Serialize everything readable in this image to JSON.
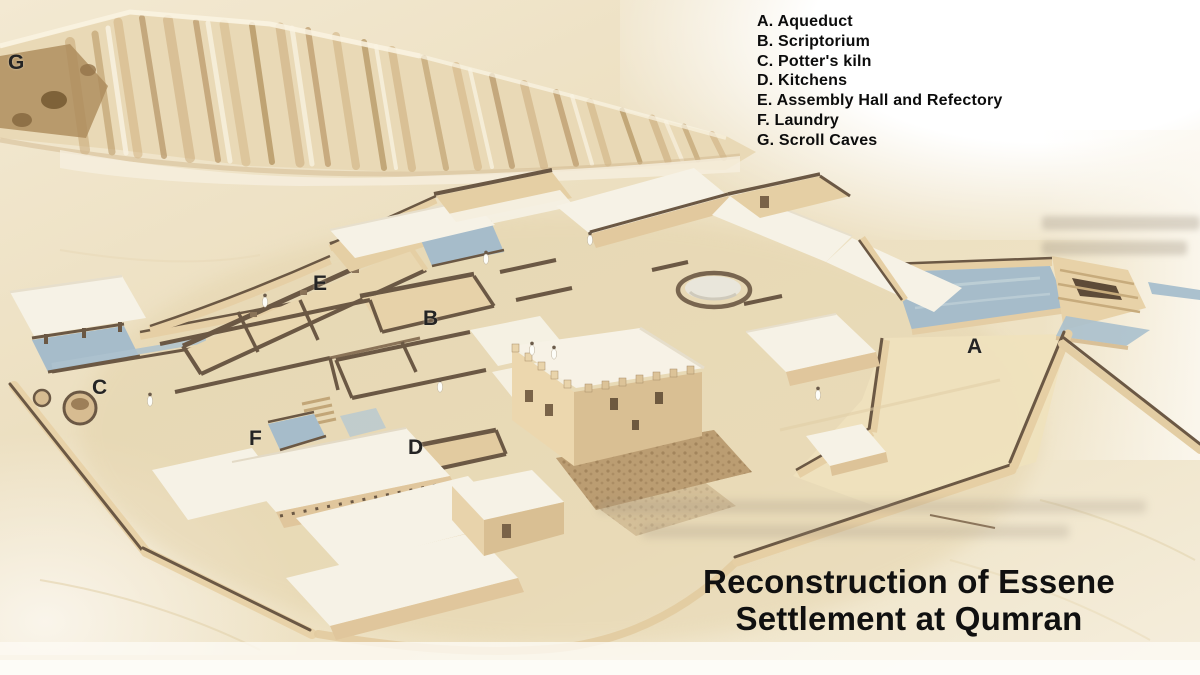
{
  "legend": {
    "items": [
      {
        "letter": "A",
        "label": "Aqueduct"
      },
      {
        "letter": "B",
        "label": "Scriptorium"
      },
      {
        "letter": "C",
        "label": "Potter's kiln"
      },
      {
        "letter": "D",
        "label": "Kitchens"
      },
      {
        "letter": "E",
        "label": "Assembly Hall and Refectory"
      },
      {
        "letter": "F",
        "label": "Laundry"
      },
      {
        "letter": "G",
        "label": "Scroll Caves"
      }
    ]
  },
  "title": {
    "line1": "Reconstruction of Essene",
    "line2": "Settlement at Qumran"
  },
  "illustration": {
    "markers": [
      {
        "letter": "A",
        "x": 967,
        "y": 336
      },
      {
        "letter": "B",
        "x": 423,
        "y": 308
      },
      {
        "letter": "C",
        "x": 92,
        "y": 377
      },
      {
        "letter": "D",
        "x": 408,
        "y": 437
      },
      {
        "letter": "E",
        "x": 313,
        "y": 273
      },
      {
        "letter": "F",
        "x": 249,
        "y": 428
      },
      {
        "letter": "G",
        "x": 8,
        "y": 52
      }
    ],
    "palette": {
      "sand": "#ecdfc0",
      "cliff": "#c4a26e",
      "wall": "#e5cfa4",
      "wall_top": "#6b5844",
      "roof": "#f6f2e6",
      "water": "#a6bcca",
      "stone": "#bb9d72",
      "label_text": "#111111"
    }
  }
}
